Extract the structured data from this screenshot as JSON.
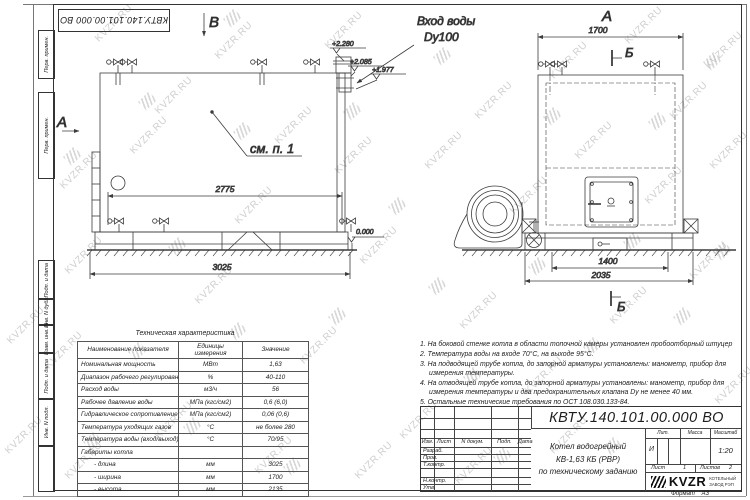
{
  "doc": {
    "number": "КВТУ.140.101.00.000  ВО"
  },
  "sidebar": {
    "boxes": [
      "Перв. примен.",
      "Перв. примен.",
      "Подп. и дата",
      "Инв. N дубл.",
      "Взам. инв. N",
      "Подп. и дата",
      "Инв. N подл."
    ]
  },
  "drawing": {
    "left_view": {
      "view_arrow_top": "В",
      "view_arrow_side": "А",
      "see_note": "см. п. 1",
      "inlet_label_1": "Вход воды",
      "inlet_label_2": "Dy100",
      "elev_1": "+2.280",
      "elev_2": "+2.085",
      "elev_3": "+1.977",
      "elev_zero": "0.000",
      "dim_body": "2775",
      "dim_overall": "3025"
    },
    "front_view": {
      "view_label": "А",
      "dim_width": "1700",
      "section_mark_top": "Б",
      "section_mark_bottom": "Б",
      "dim_base_inner": "1400",
      "dim_base": "2035"
    }
  },
  "spec_table": {
    "title": "Техническая характеристика",
    "headers": [
      "Наименование показателя",
      "Единицы измерения",
      "Значение"
    ],
    "rows": [
      [
        "Номинальная мощность",
        "МВт",
        "1,63"
      ],
      [
        "Диапазон рабочего регулирования",
        "%",
        "40-110"
      ],
      [
        "Расход воды",
        "м3/ч",
        "56"
      ],
      [
        "Рабочее давление воды",
        "МПа (кгс/см2)",
        "0,6 (6,0)"
      ],
      [
        "Гидравлическое сопротивление котла",
        "МПа (кгс/см2)",
        "0,06 (0,6)"
      ],
      [
        "Температура уходящих газов",
        "°С",
        "не более 280"
      ],
      [
        "Температура воды (вход/выход)",
        "°С",
        "70/95"
      ],
      [
        "Габариты котла",
        "",
        ""
      ],
      [
        "- длина",
        "мм",
        "3025"
      ],
      [
        "- ширина",
        "мм",
        "1700"
      ],
      [
        "- высота",
        "мм",
        "2135"
      ]
    ]
  },
  "notes": [
    "1. На боковой стенке котла в области топочной камеры установлен пробоотборный штуцер",
    "2. Температура воды на входе 70°С, на выходе 95°С.",
    "3. На подводящей трубе котла, до запорной арматуры установлены: манометр, прибор для измерения температуры.",
    "4. На отводящей трубе котла, до запорной арматуры установлены: манометр, прибор для измерения температуры и два предохранительных клапана Dy не менее 40 мм.",
    "5. Остальные технические требования по ОСТ 108.030.133-84."
  ],
  "title_block": {
    "cols": {
      "izm": "Изм.",
      "list": "Лист",
      "doc": "N докум.",
      "podp": "Подп.",
      "data": "Дата"
    },
    "roles": [
      "Разраб.",
      "Пров.",
      "Т.контр.",
      "Н.контр.",
      "Утв."
    ],
    "product_1": "Котел водогрейный",
    "product_2": "КВ-1,63 КБ (РВР)",
    "product_3": "по техническому заданию",
    "lit_label": "Лит.",
    "lit_value": "И",
    "mass_label": "Масса",
    "scale_label": "Масштаб",
    "scale_value": "1:20",
    "sheet_label": "Лист",
    "sheet_value": "1",
    "sheets_label": "Листов",
    "sheets_value": "2",
    "logo_text": "KVZR",
    "logo_sub_1": "КОТЕЛЬНЫЙ",
    "logo_sub_2": "ЗАВОД РЭП",
    "format_label": "Формат",
    "format_value": "А3"
  },
  "watermark": {
    "text": "KVZR.RU",
    "text_positions": [
      [
        2,
        320
      ],
      [
        40,
        345
      ],
      [
        0,
        430
      ],
      [
        60,
        250
      ],
      [
        55,
        165
      ],
      [
        90,
        18
      ],
      [
        125,
        130
      ],
      [
        150,
        90
      ],
      [
        190,
        280
      ],
      [
        210,
        35
      ],
      [
        230,
        200
      ],
      [
        270,
        120
      ],
      [
        295,
        340
      ],
      [
        320,
        25
      ],
      [
        330,
        150
      ],
      [
        355,
        240
      ],
      [
        395,
        415
      ],
      [
        420,
        145
      ],
      [
        455,
        305
      ],
      [
        470,
        95
      ],
      [
        505,
        190
      ],
      [
        520,
        370
      ],
      [
        545,
        55
      ],
      [
        570,
        135
      ],
      [
        605,
        300
      ],
      [
        620,
        20
      ],
      [
        640,
        180
      ],
      [
        665,
        95
      ],
      [
        685,
        255
      ],
      [
        700,
        45
      ],
      [
        705,
        145
      ],
      [
        710,
        380
      ],
      [
        150,
        415
      ],
      [
        250,
        450
      ],
      [
        350,
        455
      ],
      [
        450,
        460
      ],
      [
        545,
        430
      ],
      [
        60,
        455
      ]
    ],
    "logo_positions": [
      [
        140,
        95
      ],
      [
        235,
        125
      ],
      [
        345,
        105
      ],
      [
        225,
        12
      ],
      [
        435,
        50
      ],
      [
        545,
        110
      ],
      [
        650,
        115
      ],
      [
        65,
        150
      ],
      [
        130,
        345
      ],
      [
        230,
        325
      ],
      [
        330,
        310
      ],
      [
        430,
        280
      ],
      [
        530,
        260
      ],
      [
        625,
        235
      ],
      [
        85,
        435
      ],
      [
        185,
        420
      ],
      [
        465,
        370
      ],
      [
        585,
        340
      ],
      [
        675,
        310
      ],
      [
        705,
        55
      ],
      [
        715,
        245
      ],
      [
        285,
        460
      ],
      [
        495,
        450
      ],
      [
        605,
        440
      ],
      [
        390,
        200
      ],
      [
        170,
        240
      ]
    ]
  }
}
